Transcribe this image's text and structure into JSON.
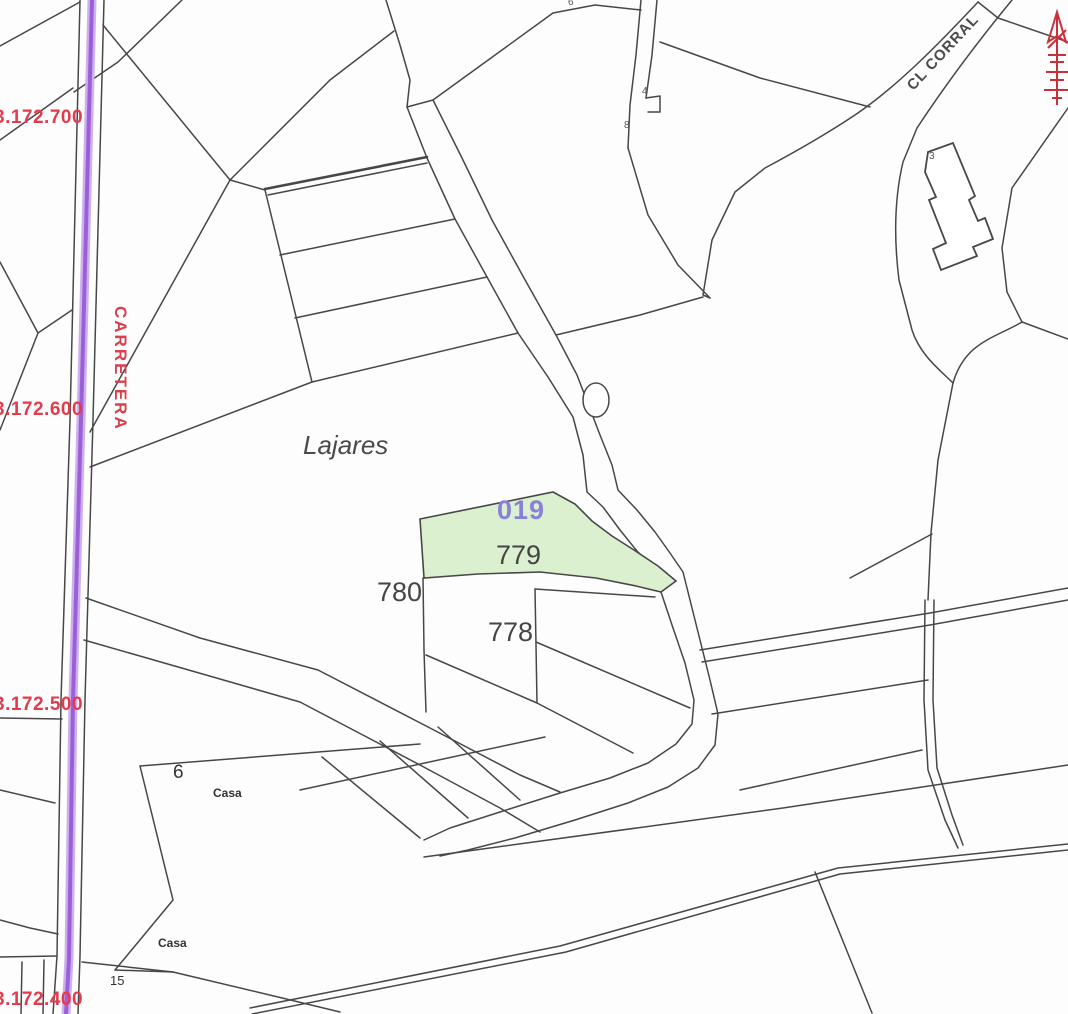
{
  "map": {
    "place": "Lajares",
    "street_left": "CARRETERA",
    "street_top_right": "CL CORRAL",
    "highlight": {
      "code": "019",
      "parcel": "779"
    },
    "parcel_780": "780",
    "parcel_778": "778",
    "casa_upper": "Casa",
    "casa_lower": "Casa",
    "house_number_6": "6",
    "house_number_15": "15",
    "tiny_number_6": "6",
    "tiny_number_4": "4",
    "tiny_number_8": "8",
    "building_number_3": "3",
    "grid": {
      "g700": "3.172.700",
      "g600": "3.172.600",
      "g500": "3.172.500",
      "g400": "3.172.400"
    },
    "colors": {
      "highlight_fill": "#daf0cf",
      "road": "#9c5fd8",
      "road_halo": "#cdb1ef",
      "grid_label": "#e23b4c",
      "parcel_code": "#8b80d9",
      "lines": "#474747",
      "north_symbol": "#c8303c"
    }
  }
}
